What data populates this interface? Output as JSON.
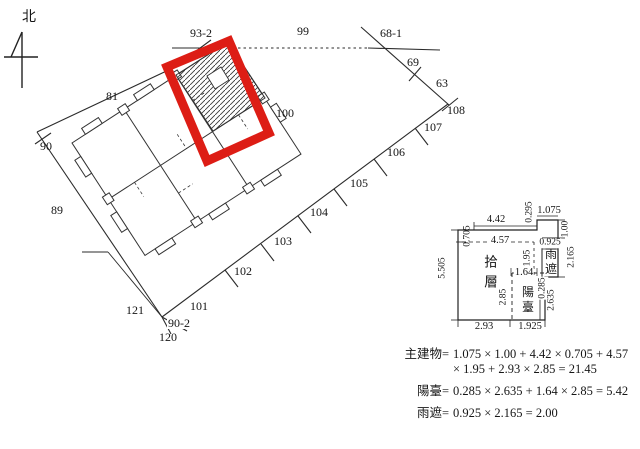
{
  "drawing": {
    "north_label": "北",
    "highlight_color": "#dd1d15",
    "line_color": "#2b2b2b"
  },
  "map": {
    "lots": {
      "l93_2": "93-2",
      "l99": "99",
      "l68_1": "68-1",
      "l69": "69",
      "l63": "63",
      "l81": "81",
      "l100": "100",
      "l108": "108",
      "l107": "107",
      "l106": "106",
      "l105": "105",
      "l104": "104",
      "l103": "103",
      "l102": "102",
      "l101": "101",
      "l90": "90",
      "l89": "89",
      "l121": "121",
      "l90_2": "90-2",
      "l120": "120"
    }
  },
  "floor_plan": {
    "floor_label": "拾層",
    "balcony_label": "陽臺",
    "canopy_label": "雨遮",
    "dims": {
      "d4_42": "4.42",
      "d0_295": "0.295",
      "d1_075": "1.075",
      "d0_705": "0.705",
      "d4_57": "4.57",
      "d1_00": "1.00",
      "d0_925": "0.925",
      "d1_95": "1.95",
      "d2_165": "2.165",
      "d5_505": "5.505",
      "d1_64": "1.64",
      "d0_285": "0.285",
      "d2_85": "2.85",
      "d2_635": "2.635",
      "d2_93": "2.93",
      "d1_925": "1.925"
    }
  },
  "formulas": {
    "main_label": "主建物=",
    "main_line1": "1.075 × 1.00 + 4.42 × 0.705 + 4.57",
    "main_line2": "× 1.95 + 2.93 × 2.85 = 21.45",
    "balcony_label": "陽臺=",
    "balcony_line": "0.285 × 2.635 + 1.64 × 2.85 = 5.42",
    "canopy_label": "雨遮=",
    "canopy_line": "0.925 × 2.165 = 2.00"
  }
}
